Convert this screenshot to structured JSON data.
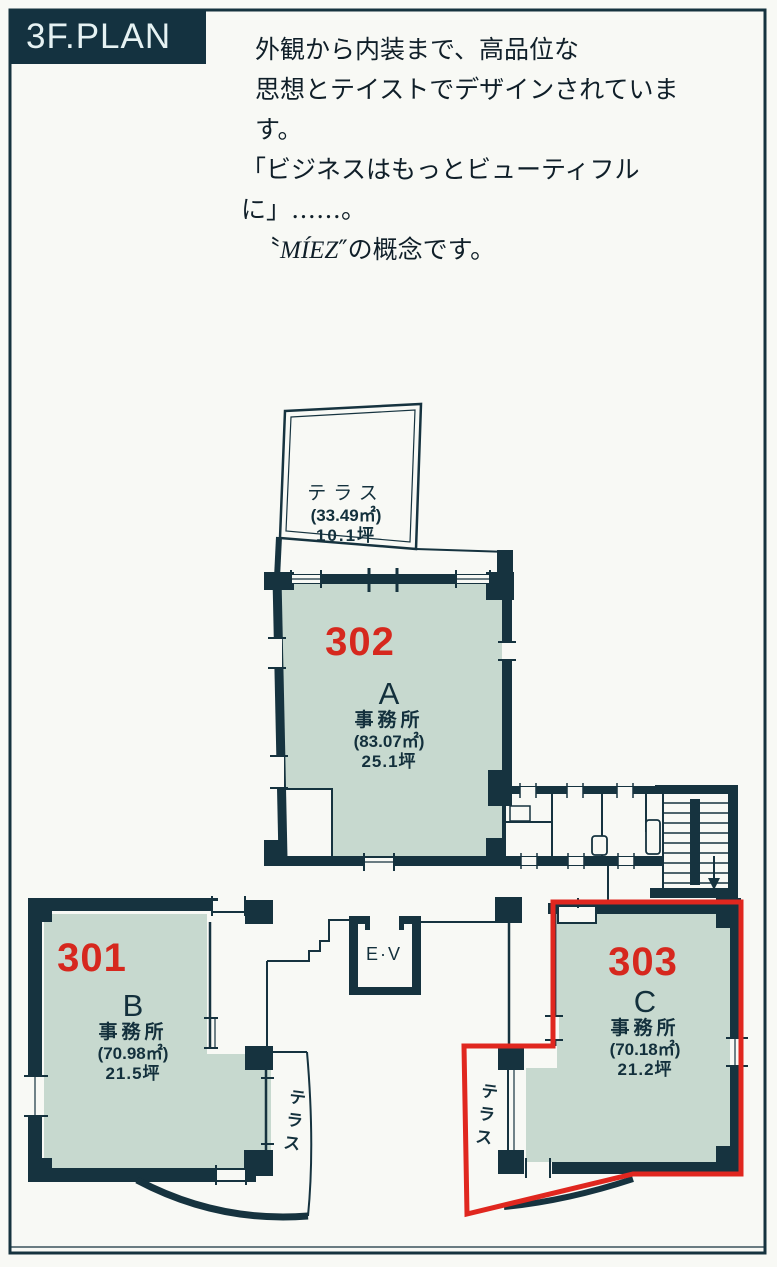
{
  "header": {
    "title": "3F.PLAN"
  },
  "intro": {
    "line1": "外観から内装まで、高品位な",
    "line2": "思想とテイストでデザインされています。",
    "line3": "「ビジネスはもっとビューティフルに」……。",
    "brand_prefix": "〝",
    "brand": "MÍEZ",
    "brand_suffix": "″の概念です。"
  },
  "plan": {
    "roof_terrace": {
      "label": "テラス",
      "area": "(33.49㎡)",
      "tsubo": "10.1坪"
    },
    "units": [
      {
        "id": "A",
        "number": "302",
        "letter": "A",
        "use": "事務所",
        "area": "(83.07㎡)",
        "tsubo": "25.1坪",
        "highlighted": false
      },
      {
        "id": "B",
        "number": "301",
        "letter": "B",
        "use": "事務所",
        "area": "(70.98㎡)",
        "tsubo": "21.5坪",
        "highlighted": false
      },
      {
        "id": "C",
        "number": "303",
        "letter": "C",
        "use": "事務所",
        "area": "(70.18㎡)",
        "tsubo": "21.2坪",
        "highlighted": true
      }
    ],
    "elevator_label": "E·V",
    "terrace_b_label": "テラス",
    "terrace_c_label": "テラス"
  },
  "colors": {
    "wall": "#16333f",
    "unit_fill": "#c7d9cf",
    "highlight_outline": "#e0271f",
    "unit_number": "#d6281e",
    "title_bg": "#143240",
    "title_text": "#e6f2f3"
  }
}
